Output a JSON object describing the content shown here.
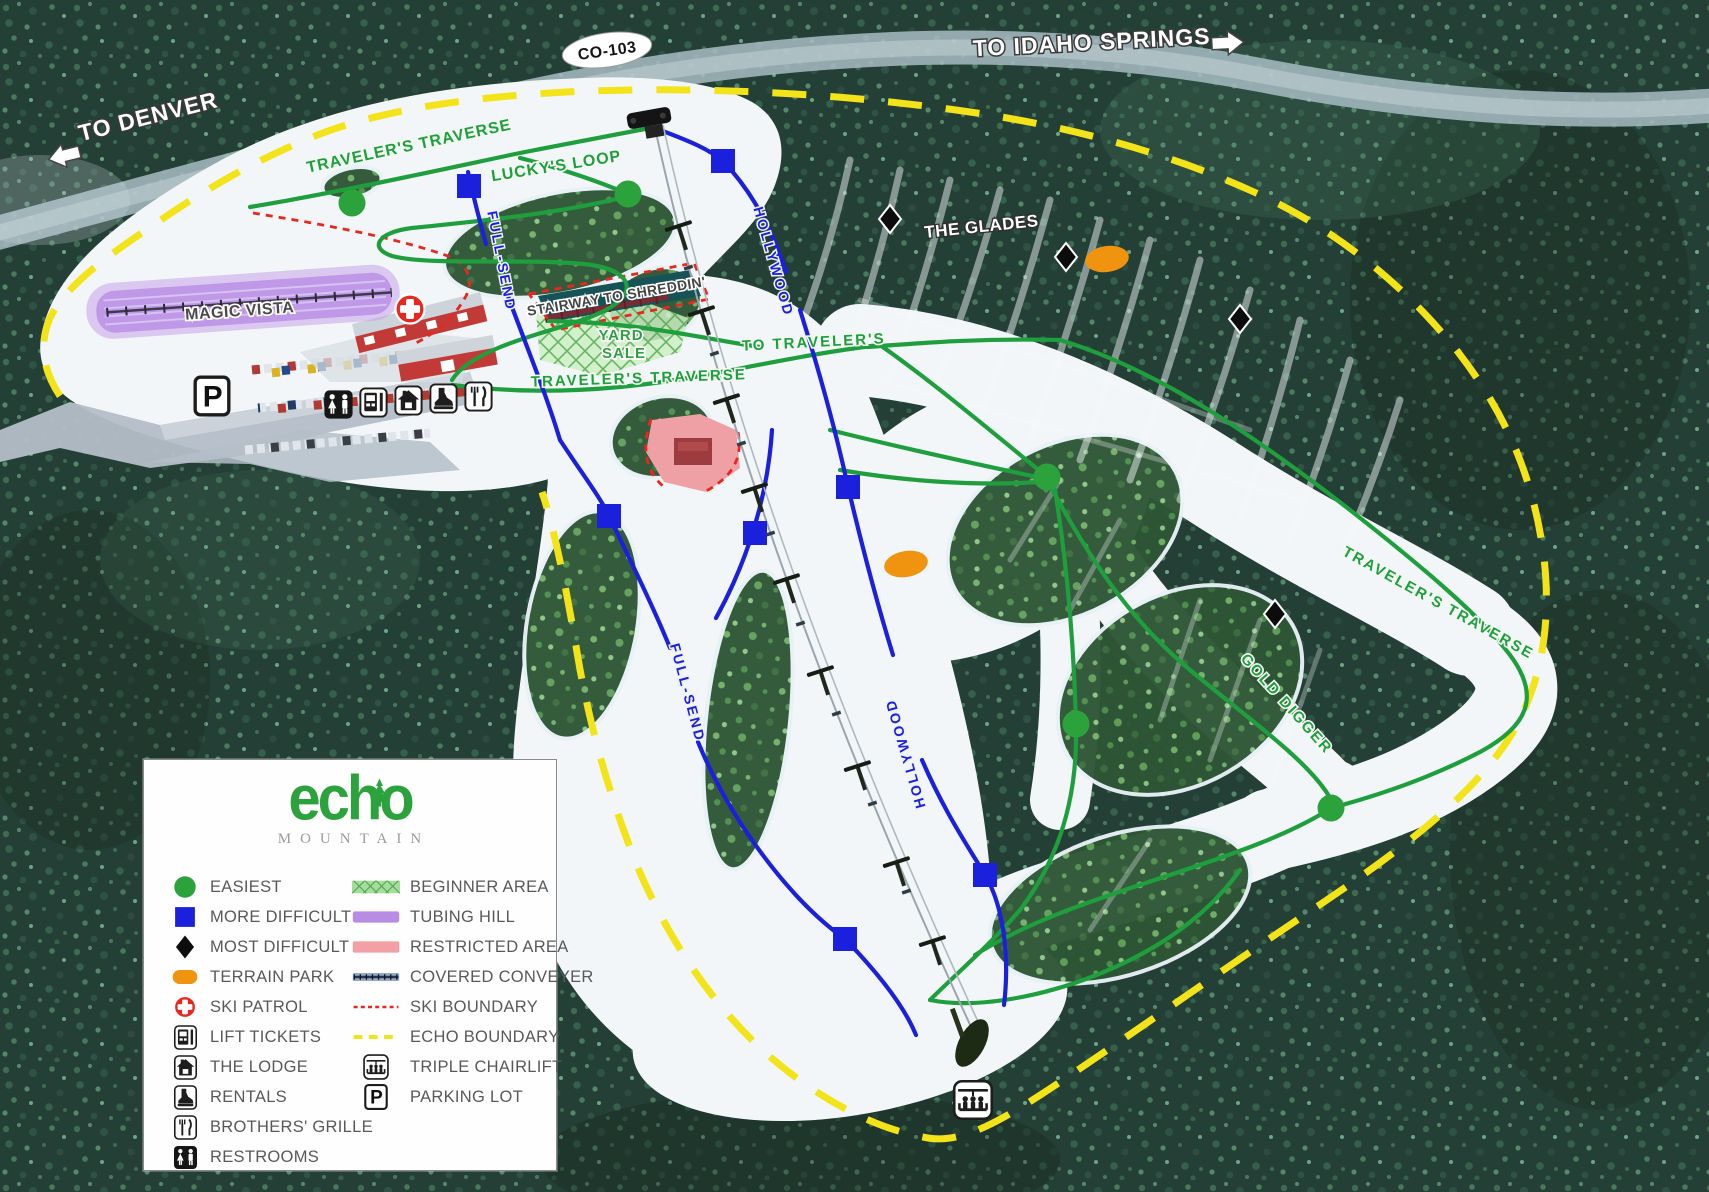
{
  "road": {
    "badge": "CO-103",
    "to_idaho": "TO IDAHO SPRINGS",
    "to_denver": "TO DENVER"
  },
  "labels": {
    "tt_top": "TRAVELER'S TRAVERSE",
    "luckys_loop": "LUCKY'S LOOP",
    "full_send_upper": "FULL-SEND",
    "hollywood_upper": "HOLLYWOOD",
    "magic_vista": "MAGIC VISTA",
    "stairway": "STAIRWAY TO SHREDDIN'",
    "yard": "YARD",
    "sale": "SALE",
    "to_travelers": "TO TRAVELER'S",
    "tt_mid": "TRAVELER'S TRAVERSE",
    "the_glades": "THE GLADES",
    "full_send_lower": "FULL-SEND",
    "hollywood_lower": "HOLLYWOOD",
    "gold_digger": "GOLD DIGGER",
    "tt_right": "TRAVELER'S TRAVERSE",
    "parking_letter": "P"
  },
  "legend": {
    "logo_text": "echo",
    "logo_subtext": "MOUNTAIN",
    "left": [
      {
        "icon": "easiest-circle",
        "label": "EASIEST"
      },
      {
        "icon": "more-difficult-square",
        "label": "MORE DIFFICULT"
      },
      {
        "icon": "most-difficult-diamond",
        "label": "MOST DIFFICULT"
      },
      {
        "icon": "terrain-park-oval",
        "label": "TERRAIN PARK"
      },
      {
        "icon": "ski-patrol-cross",
        "label": "SKI PATROL"
      },
      {
        "icon": "lift-tickets",
        "label": "LIFT TICKETS"
      },
      {
        "icon": "the-lodge",
        "label": "THE LODGE"
      },
      {
        "icon": "rentals",
        "label": "RENTALS"
      },
      {
        "icon": "brothers-grille",
        "label": "BROTHERS' GRILLE"
      },
      {
        "icon": "restrooms",
        "label": "RESTROOMS"
      }
    ],
    "right": [
      {
        "icon": "beginner-area-swatch",
        "label": "BEGINNER AREA"
      },
      {
        "icon": "tubing-hill-swatch",
        "label": "TUBING HILL"
      },
      {
        "icon": "restricted-area-swatch",
        "label": "RESTRICTED AREA"
      },
      {
        "icon": "covered-conveyer-swatch",
        "label": "COVERED CONVEYER"
      },
      {
        "icon": "ski-boundary-dashes",
        "label": "SKI BOUNDARY"
      },
      {
        "icon": "echo-boundary-dashes",
        "label": "ECHO BOUNDARY"
      },
      {
        "icon": "triple-chairlift",
        "label": "TRIPLE CHAIRLIFT"
      },
      {
        "icon": "parking-lot",
        "label": "PARKING LOT"
      }
    ]
  },
  "colors": {
    "easiest_green": "#2ca23c",
    "difficult_blue": "#1a20dc",
    "expert_black": "#0d0d0d",
    "terrain_park_orange": "#f0930f",
    "ski_patrol_red": "#e8281e",
    "ski_boundary_red": "#e8281e",
    "echo_boundary_yellow": "#f2e418",
    "trail_green": "#1f9e3d",
    "beginner_area_green": "#a6dd9e",
    "tubing_hill_purple": "#b88ce5",
    "restricted_area_pink": "#efa0a5",
    "logo_green": "#2ca23c"
  }
}
